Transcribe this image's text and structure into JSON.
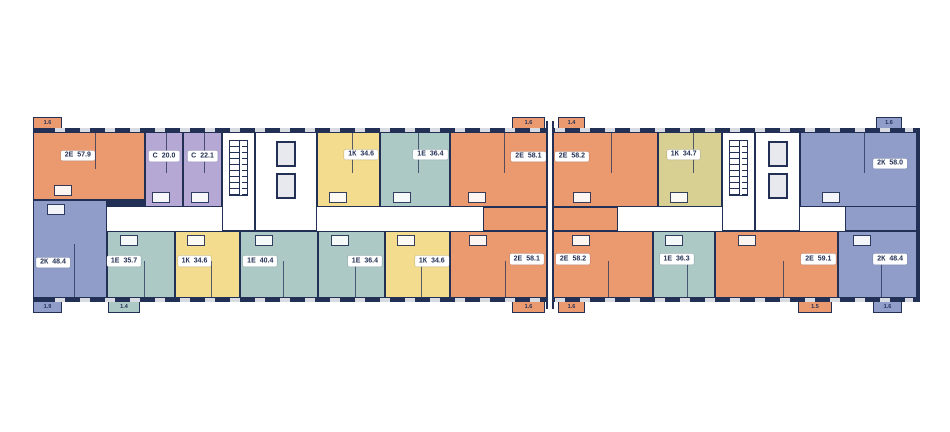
{
  "floorplan": {
    "wall_color": "#233055",
    "corridor_color": "#ffffff",
    "window_color": "#d8dbe2",
    "palette": {
      "orange": "#EB9A70",
      "purple": "#B5A8D5",
      "yellow": "#F3DC8D",
      "olive": "#D8CF92",
      "teal": "#ACC9C6",
      "periwinkle": "#909DC9"
    },
    "apartments": [
      {
        "row": "top",
        "type": "2Е",
        "area": "57.9",
        "color": "orange",
        "x": 33,
        "w": 112,
        "y": 132,
        "h": 68,
        "cx": 0.4,
        "cy": 0.35
      },
      {
        "row": "top",
        "type": "С",
        "area": "20.0",
        "color": "purple",
        "x": 145,
        "w": 38,
        "cx": 0.5,
        "cy": 0.32
      },
      {
        "row": "top",
        "type": "С",
        "area": "22.1",
        "color": "purple",
        "x": 183,
        "w": 39,
        "cx": 0.5,
        "cy": 0.32
      },
      {
        "row": "top",
        "type": "1К",
        "area": "34.6",
        "color": "yellow",
        "x": 317,
        "w": 63,
        "cx": 0.7,
        "cy": 0.3
      },
      {
        "row": "top",
        "type": "1Е",
        "area": "36.4",
        "color": "teal",
        "x": 380,
        "w": 70,
        "cx": 0.72,
        "cy": 0.3
      },
      {
        "row": "top",
        "type": "2Е",
        "area": "58.1",
        "color": "orange",
        "x": 450,
        "w": 98,
        "cx": 0.8,
        "cy": 0.33
      },
      {
        "row": "top",
        "type": "2Е",
        "area": "58.2",
        "color": "orange",
        "x": 553,
        "w": 105,
        "cx": 0.18,
        "cy": 0.33
      },
      {
        "row": "top",
        "type": "1К",
        "area": "34.7",
        "color": "olive",
        "x": 658,
        "w": 64,
        "cx": 0.4,
        "cy": 0.3
      },
      {
        "row": "top",
        "type": "2К",
        "area": "58.0",
        "color": "periwinkle",
        "x": 800,
        "w": 117,
        "cx": 0.77,
        "cy": 0.42
      },
      {
        "row": "bottom",
        "type": "2К",
        "area": "48.4",
        "color": "periwinkle",
        "x": 33,
        "w": 74,
        "y": 200,
        "h": 98,
        "cx": 0.27,
        "cy": 0.64
      },
      {
        "row": "bottom",
        "type": "1Е",
        "area": "35.7",
        "color": "teal",
        "x": 107,
        "w": 68,
        "cx": 0.25,
        "cy": 0.45
      },
      {
        "row": "bottom",
        "type": "1К",
        "area": "34.6",
        "color": "yellow",
        "x": 175,
        "w": 65,
        "cx": 0.3,
        "cy": 0.45
      },
      {
        "row": "bottom",
        "type": "1Е",
        "area": "40.4",
        "color": "teal",
        "x": 240,
        "w": 78,
        "cx": 0.26,
        "cy": 0.45
      },
      {
        "row": "bottom",
        "type": "1Е",
        "area": "36.4",
        "color": "teal",
        "x": 318,
        "w": 67,
        "cx": 0.7,
        "cy": 0.45
      },
      {
        "row": "bottom",
        "type": "1К",
        "area": "34.6",
        "color": "yellow",
        "x": 385,
        "w": 65,
        "cx": 0.72,
        "cy": 0.45
      },
      {
        "row": "bottom",
        "type": "2Е",
        "area": "58.1",
        "color": "orange",
        "x": 450,
        "w": 101,
        "cx": 0.76,
        "cy": 0.42
      },
      {
        "row": "bottom",
        "type": "2Е",
        "area": "58.2",
        "color": "orange",
        "x": 553,
        "w": 100,
        "cx": 0.2,
        "cy": 0.42
      },
      {
        "row": "bottom",
        "type": "1Е",
        "area": "36.3",
        "color": "teal",
        "x": 653,
        "w": 62,
        "cx": 0.38,
        "cy": 0.42
      },
      {
        "row": "bottom",
        "type": "2Е",
        "area": "59.1",
        "color": "orange",
        "x": 715,
        "w": 123,
        "cx": 0.84,
        "cy": 0.42
      },
      {
        "row": "bottom",
        "type": "2К",
        "area": "48.4",
        "color": "periwinkle",
        "x": 838,
        "w": 79,
        "cx": 0.66,
        "cy": 0.42
      }
    ],
    "cores": [
      {
        "kind": "stairs",
        "x": 222,
        "w": 33
      },
      {
        "kind": "elevator",
        "x": 255,
        "w": 62
      },
      {
        "kind": "stairs",
        "x": 722,
        "w": 33
      },
      {
        "kind": "elevator",
        "x": 755,
        "w": 45
      }
    ],
    "extensions": [
      {
        "x": 483,
        "y": 207,
        "w": 135,
        "h": 24,
        "color": "orange"
      },
      {
        "x": 845,
        "y": 200,
        "w": 72,
        "h": 31,
        "color": "periwinkle"
      }
    ],
    "balconies": [
      {
        "edge": "top",
        "x": 33,
        "w": 29,
        "color": "orange",
        "label": "1.6"
      },
      {
        "edge": "top",
        "x": 512,
        "w": 33,
        "color": "orange",
        "label": "1.6"
      },
      {
        "edge": "top",
        "x": 558,
        "w": 27,
        "color": "orange",
        "label": "1.4"
      },
      {
        "edge": "top",
        "x": 876,
        "w": 26,
        "color": "periwinkle",
        "label": "1.6"
      },
      {
        "edge": "bottom",
        "x": 33,
        "w": 29,
        "color": "periwinkle",
        "label": "1.9"
      },
      {
        "edge": "bottom",
        "x": 108,
        "w": 32,
        "color": "teal",
        "label": "1.4"
      },
      {
        "edge": "bottom",
        "x": 512,
        "w": 33,
        "color": "orange",
        "label": "1.6"
      },
      {
        "edge": "bottom",
        "x": 558,
        "w": 27,
        "color": "orange",
        "label": "1.6"
      },
      {
        "edge": "bottom",
        "x": 798,
        "w": 34,
        "color": "orange",
        "label": "1.5"
      },
      {
        "edge": "bottom",
        "x": 873,
        "w": 29,
        "color": "periwinkle",
        "label": "1.6"
      }
    ]
  }
}
